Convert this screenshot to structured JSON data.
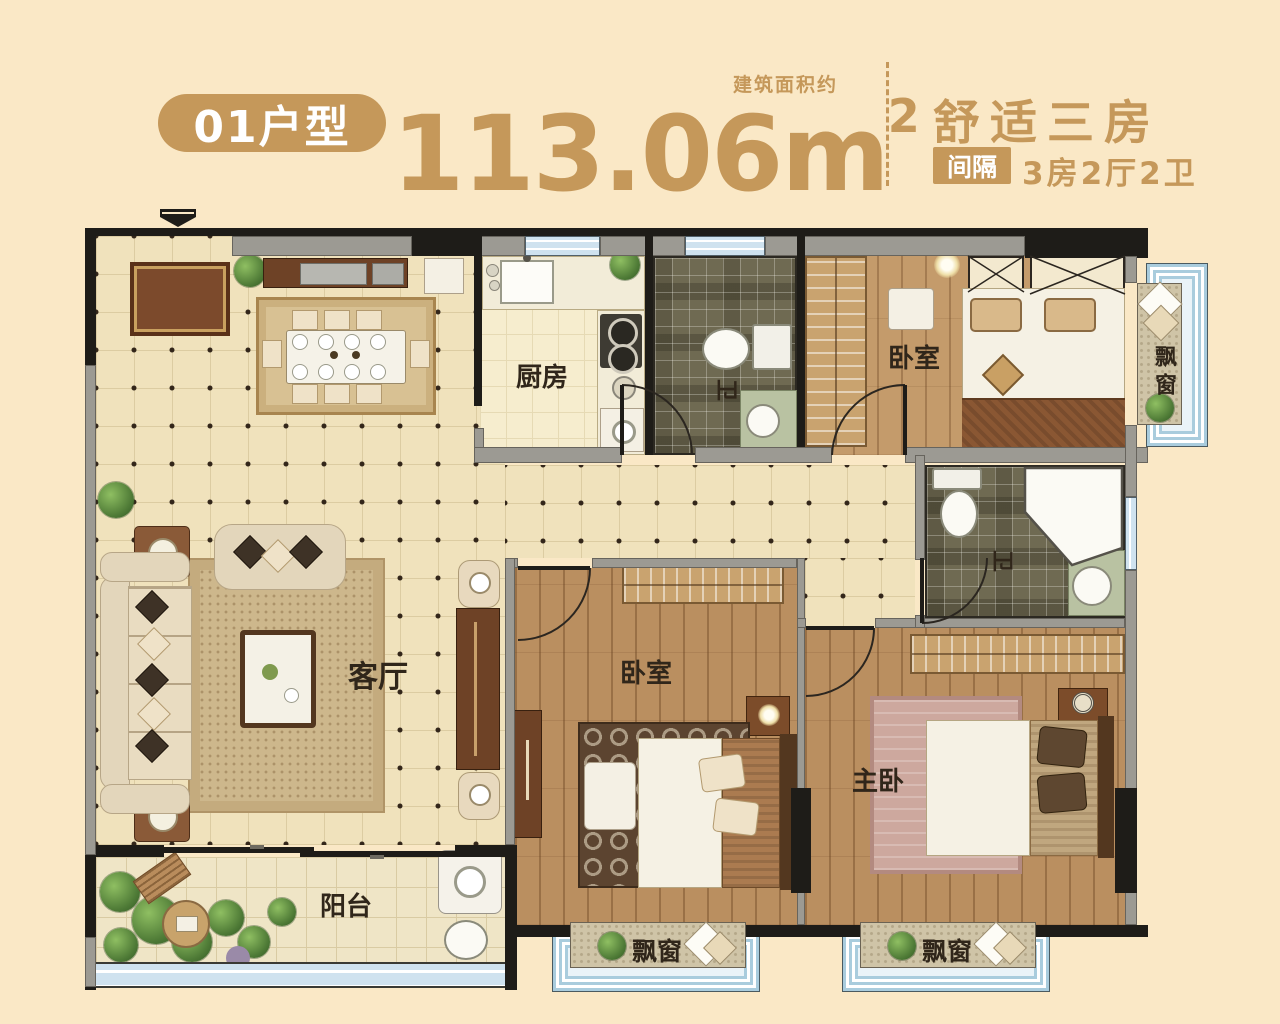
{
  "header": {
    "unit_badge": "01户型",
    "area_number": "113.06m",
    "area_superscript": "2",
    "area_note": "建筑面积约",
    "title": "舒适三房",
    "layout_tag": "间隔",
    "layout_text": "3房2厅2卫"
  },
  "rooms": {
    "kitchen": "厨房",
    "bath_top": "卫",
    "bath_master": "卫",
    "bedroom_top": "卧室",
    "bedroom_mid": "卧室",
    "master_bedroom": "主卧",
    "living": "客厅",
    "balcony": "阳台",
    "bay_window_right": "飘窗",
    "bay_window_bottom_left": "飘窗",
    "bay_window_bottom_right": "飘窗"
  },
  "colors": {
    "background": "#FAE8C6",
    "accent_gold": "#C5985A",
    "wall_dark": "#1E1C18",
    "wall_gray": "#9C9A93",
    "window_blue": "#CFE2EF",
    "label_dark": "#30261A"
  }
}
